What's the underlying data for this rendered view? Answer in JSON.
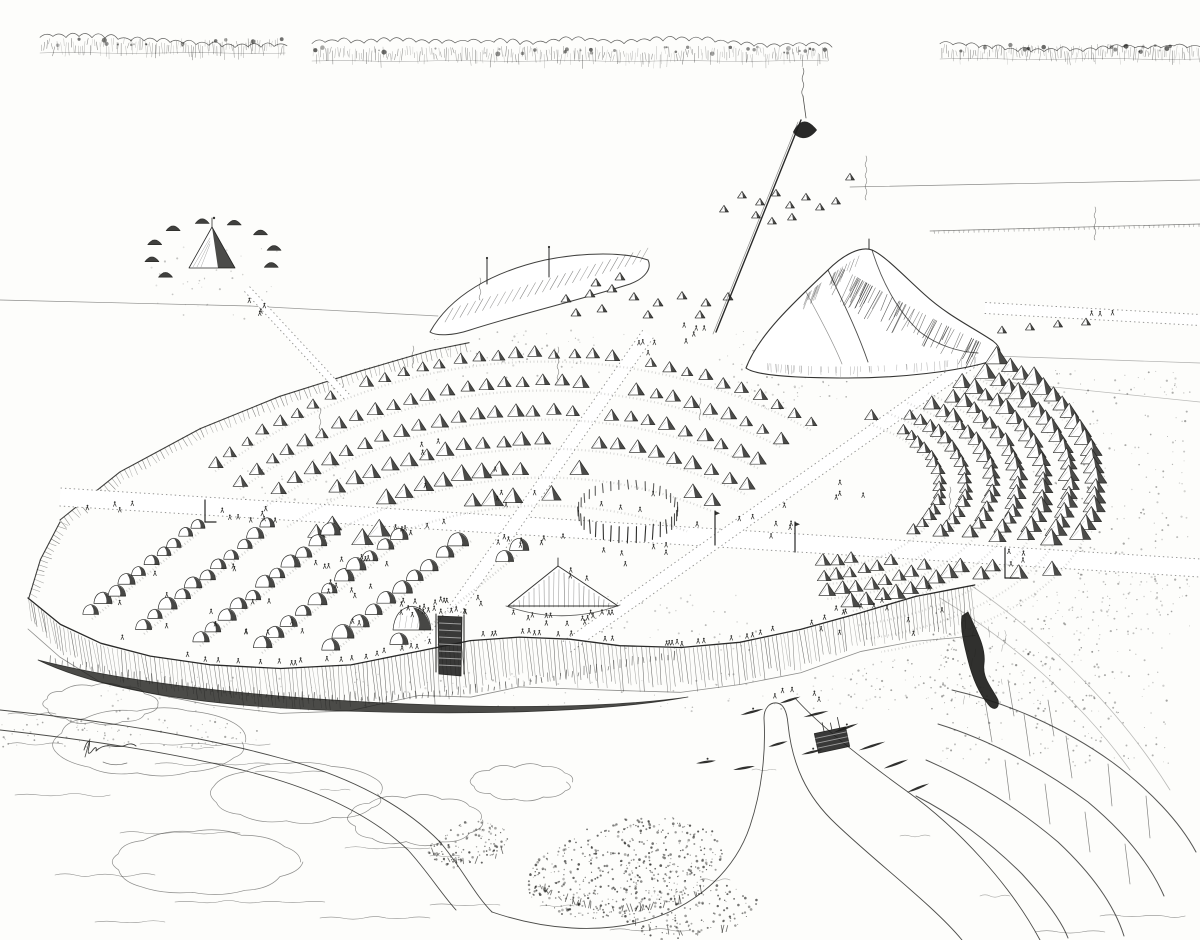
{
  "meta": {
    "title": "Pen-and-ink aerial reconstruction drawing of a fortified native settlement on a river bluff",
    "medium": "black ink on white paper",
    "ink": "#1e1e1c",
    "paper": "#fdfdfb",
    "signature_present": true,
    "signature_legible": false
  },
  "scene": {
    "treeline": [
      {
        "x1": 40,
        "x2": 285,
        "y": 50
      },
      {
        "x1": 312,
        "x2": 828,
        "y": 58
      },
      {
        "x1": 940,
        "x2": 1200,
        "y": 56
      }
    ],
    "field_lines": [
      [
        0,
        300,
        250,
        306,
        0.5
      ],
      [
        250,
        306,
        438,
        316,
        0.45
      ],
      [
        850,
        187,
        1200,
        180,
        0.5
      ],
      [
        995,
        356,
        1200,
        363,
        0.35
      ],
      [
        985,
        380,
        1200,
        402,
        0.3
      ],
      [
        940,
        598,
        1130,
        770,
        0.0
      ],
      [
        0,
        0,
        0,
        0,
        0
      ]
    ],
    "slope_lines": [
      "M940,598 C1010,640 1080,700 1130,770",
      "M972,586 C1050,640 1120,710 1170,790"
    ],
    "tick_line": [
      930,
      231,
      1200,
      224
    ],
    "stipple_patches": [
      [
        1030,
        370,
        160,
        250,
        260,
        0.3
      ],
      [
        700,
        330,
        150,
        55,
        60,
        0.28
      ],
      [
        430,
        330,
        200,
        50,
        55,
        0.25
      ],
      [
        240,
        460,
        110,
        50,
        35,
        0.22
      ],
      [
        600,
        595,
        170,
        55,
        45,
        0.25
      ],
      [
        930,
        600,
        170,
        110,
        150,
        0.35
      ],
      [
        940,
        646,
        230,
        120,
        160,
        0.3
      ],
      [
        100,
        672,
        850,
        40,
        140,
        0.22
      ],
      [
        1060,
        560,
        130,
        80,
        60,
        0.25
      ],
      [
        730,
        380,
        120,
        30,
        30,
        0.25
      ],
      [
        150,
        240,
        130,
        80,
        40,
        0.2
      ],
      [
        830,
        660,
        120,
        40,
        40,
        0.3
      ],
      [
        0,
        718,
        260,
        30,
        90,
        0.3
      ]
    ],
    "roads": [
      {
        "name": "east-west-road",
        "seg": [
          60,
          497,
          1200,
          568
        ],
        "half": 9
      },
      {
        "name": "northwest-road",
        "seg": [
          648,
          334,
          430,
          645
        ],
        "half": 6.5
      },
      {
        "name": "northeast-road",
        "seg": [
          985,
          352,
          565,
          648
        ],
        "half": 6.5
      },
      {
        "name": "satellite-path",
        "seg": [
          247,
          289,
          348,
          398
        ],
        "half": 3.5
      },
      {
        "name": "east-road",
        "seg": [
          985,
          308,
          1200,
          320
        ],
        "half": 5.5
      }
    ],
    "avoid": [
      [
        412,
        628,
        26
      ],
      [
        563,
        600,
        62
      ],
      [
        628,
        516,
        62
      ]
    ],
    "west_scarp": [
      [
        60,
        520
      ],
      [
        120,
        472
      ],
      [
        200,
        428
      ],
      [
        280,
        396
      ],
      [
        360,
        370
      ],
      [
        430,
        350
      ],
      [
        470,
        342
      ]
    ],
    "west_corner": [
      [
        60,
        522
      ],
      [
        40,
        560
      ],
      [
        28,
        598
      ]
    ],
    "satellite_camp": {
      "cx": 213,
      "cy": 256,
      "rx": 62,
      "ry": 33,
      "ring_angles": [
        140,
        170,
        200,
        230,
        260,
        290,
        320,
        350,
        20
      ],
      "cone": {
        "apex": [
          212,
          227
        ],
        "base_y": 268,
        "half_w": 23
      }
    },
    "ridge_mound": {
      "outline": "M430,332 C450,296 492,272 545,260 C585,252 625,252 648,260 C652,268 646,278 630,284 C580,300 520,314 470,330 C452,336 436,336 430,332 Z",
      "hatch_a": [
        445,
        322
      ],
      "hatch_b": [
        640,
        262
      ],
      "poles": [
        [
          487,
          258,
          26
        ],
        [
          549,
          247,
          30
        ]
      ]
    },
    "hut_clusters": {
      "north": [
        [
          742,
          198
        ],
        [
          760,
          205
        ],
        [
          776,
          196
        ],
        [
          790,
          208
        ],
        [
          806,
          200
        ],
        [
          820,
          210
        ],
        [
          836,
          204
        ],
        [
          756,
          218
        ],
        [
          772,
          224
        ],
        [
          792,
          220
        ],
        [
          850,
          180
        ],
        [
          724,
          212
        ]
      ],
      "ridge_east": [
        [
          566,
          302
        ],
        [
          590,
          297
        ],
        [
          612,
          292
        ],
        [
          634,
          300
        ],
        [
          658,
          306
        ],
        [
          682,
          299
        ],
        [
          706,
          306
        ],
        [
          728,
          300
        ],
        [
          576,
          316
        ],
        [
          602,
          312
        ],
        [
          648,
          318
        ],
        [
          700,
          318
        ],
        [
          596,
          286
        ],
        [
          620,
          280
        ]
      ],
      "east_road": [
        [
          1002,
          333
        ],
        [
          1030,
          330
        ],
        [
          1058,
          327
        ],
        [
          1086,
          325
        ]
      ]
    },
    "great_mound": {
      "outline": "M746,368 C758,336 792,304 828,270 C844,254 861,246 872,250 C884,255 902,274 924,294 C948,316 974,328 993,341 C1002,348 1002,356 995,360 C958,372 898,378 848,378 C798,378 756,376 746,368 Z",
      "ridge": "M828,270 C842,300 857,330 868,362",
      "terrace": "M872,250 C882,282 898,312 920,332 C938,346 960,352 978,353",
      "terrace2": "M806,292 C820,318 834,344 842,364",
      "hatch_se": [
        [
          838,
          266
        ],
        [
          904,
          306
        ],
        [
          988,
          346
        ]
      ],
      "hatch_nw": [
        [
          800,
          300
        ],
        [
          833,
          272
        ],
        [
          862,
          254
        ]
      ],
      "skirt": [
        [
          756,
          362
        ],
        [
          850,
          374
        ],
        [
          985,
          356
        ]
      ],
      "summit": [
        869,
        249
      ]
    },
    "arc_band_upper": {
      "cx": 545,
      "cy": 905,
      "rows": [
        [
          548,
          233,
          299,
          2.0,
          6.5
        ],
        [
          519,
          234,
          298,
          2.1,
          7.2
        ],
        [
          490,
          235,
          297,
          2.25,
          7.8
        ],
        [
          461,
          236,
          296,
          2.4,
          8.5
        ],
        [
          432,
          238,
          294,
          2.6,
          9.2
        ],
        [
          404,
          243,
          291,
          2.8,
          10
        ]
      ]
    },
    "arc_band_east": {
      "cx": 800,
      "cy": 488,
      "k": 0.56,
      "rows": [
        [
          140,
          -60,
          84,
          5.6,
          6.8
        ],
        [
          166,
          -58,
          82,
          5.0,
          7.4
        ],
        [
          192,
          -56,
          82,
          4.6,
          8.0
        ],
        [
          218,
          -54,
          80,
          4.2,
          8.6
        ],
        [
          244,
          -52,
          80,
          3.9,
          9.2
        ],
        [
          270,
          -50,
          78,
          3.6,
          9.7
        ],
        [
          296,
          -48,
          76,
          3.3,
          10.2
        ]
      ]
    },
    "post_circle": {
      "cx": 628,
      "cy": 516,
      "rx": 50,
      "ry": 27,
      "n": 36
    },
    "lodge_rows": {
      "dir": [
        0.78,
        -0.63
      ],
      "rows": [
        [
          92,
          614,
          10,
          8
        ],
        [
          144,
          629,
          11,
          8.4
        ],
        [
          200,
          641,
          11,
          8.8
        ],
        [
          262,
          648,
          12,
          9.2
        ],
        [
          330,
          650,
          11,
          9.6
        ],
        [
          400,
          645,
          9,
          10
        ]
      ]
    },
    "plaza_mound": {
      "x1": 508,
      "apex": [
        558,
        566
      ],
      "x2": 618,
      "base_y": 606
    },
    "dome_mound": {
      "cx": 412,
      "cy": 630,
      "s": 19
    },
    "bluff": [
      [
        28,
        598
      ],
      [
        60,
        625
      ],
      [
        100,
        644
      ],
      [
        150,
        656
      ],
      [
        210,
        664
      ],
      [
        280,
        668
      ],
      [
        350,
        664
      ],
      [
        420,
        650
      ],
      [
        470,
        640
      ],
      [
        520,
        637
      ],
      [
        570,
        640
      ],
      [
        620,
        645
      ],
      [
        680,
        648
      ],
      [
        740,
        642
      ],
      [
        800,
        630
      ],
      [
        860,
        612
      ],
      [
        915,
        597
      ],
      [
        955,
        588
      ],
      [
        975,
        584
      ]
    ],
    "gate": {
      "x": 438,
      "y": 616,
      "w": 24,
      "h": 60
    },
    "ravine": "M968,612 C978,634 986,648 984,664 C982,678 992,688 998,700 C1000,708 994,712 988,704 C978,692 972,676 968,660 C964,644 960,628 962,616 Z",
    "slough": "M38,660 C140,686 300,702 470,706 C560,708 640,704 688,697 C600,713 460,716 320,710 C200,705 100,690 38,660 Z",
    "river_banks": [
      "M0,710 C100,720 200,736 280,758 C350,776 405,806 440,842 C462,868 474,894 492,912",
      "M0,730 C90,740 180,754 250,772 C320,790 372,816 408,850 C428,872 440,892 456,910",
      "M492,912 C545,930 600,934 648,920 C700,904 736,868 750,826 C762,790 766,752 764,718 C764,708 770,702 777,703 C784,704 787,712 788,724 C792,764 806,796 836,824 C878,864 934,906 962,940",
      "M795,698 C818,724 858,756 908,792 C958,828 1010,884 1040,940"
    ],
    "water_wiggles": [
      [
        180,
        748,
        34
      ],
      [
        320,
        790,
        30
      ],
      [
        430,
        856,
        30
      ],
      [
        540,
        906,
        34
      ],
      [
        700,
        880,
        30
      ],
      [
        752,
        770,
        24
      ],
      [
        900,
        836,
        30
      ],
      [
        980,
        896,
        30
      ]
    ],
    "ground_wiggles": [
      [
        15,
        795,
        95
      ],
      [
        120,
        833,
        120
      ],
      [
        55,
        875,
        100
      ],
      [
        175,
        902,
        150
      ],
      [
        320,
        918,
        110
      ],
      [
        95,
        922,
        70
      ],
      [
        255,
        772,
        70
      ],
      [
        345,
        848,
        85
      ],
      [
        610,
        930,
        80
      ],
      [
        1100,
        916,
        85
      ],
      [
        1035,
        932,
        70
      ],
      [
        140,
        744,
        130
      ],
      [
        155,
        764,
        115
      ],
      [
        8,
        744,
        55
      ],
      [
        8,
        714,
        48
      ],
      [
        430,
        905,
        70
      ]
    ],
    "clouds": [
      [
        150,
        742,
        95,
        32
      ],
      [
        100,
        704,
        55,
        18
      ],
      [
        298,
        794,
        85,
        28
      ],
      [
        205,
        862,
        92,
        30
      ],
      [
        415,
        820,
        66,
        24
      ],
      [
        522,
        782,
        48,
        16
      ]
    ],
    "tree_masses": [
      [
        625,
        868,
        100,
        48,
        -12,
        520
      ],
      [
        468,
        844,
        42,
        22,
        -15,
        120
      ],
      [
        690,
        912,
        70,
        26,
        -8,
        140
      ]
    ],
    "right_bluffs": {
      "curves": [
        "M952,690 C1004,702 1062,726 1112,762 C1150,790 1180,822 1196,852",
        "M938,724 C990,740 1042,768 1088,802 C1124,832 1150,864 1164,896",
        "M926,760 C972,780 1018,808 1058,842 C1090,872 1114,904 1124,936",
        "M916,796 C952,814 990,842 1022,874 C1046,900 1062,922 1068,938"
      ],
      "cracks": [
        [
          985,
          700,
          992,
          742
        ],
        [
          1024,
          714,
          1030,
          756
        ],
        [
          1066,
          736,
          1072,
          778
        ],
        [
          1108,
          764,
          1112,
          806
        ],
        [
          1146,
          796,
          1150,
          838
        ],
        [
          1008,
          680,
          1014,
          716
        ],
        [
          1048,
          700,
          1054,
          736
        ],
        [
          1005,
          760,
          1010,
          800
        ],
        [
          1045,
          784,
          1050,
          824
        ],
        [
          1085,
          812,
          1090,
          852
        ],
        [
          1125,
          844,
          1130,
          884
        ]
      ]
    },
    "canoes": [
      [
        752,
        712,
        -15,
        24
      ],
      [
        790,
        700,
        -18,
        22
      ],
      [
        816,
        714,
        -14,
        26
      ],
      [
        846,
        728,
        -20,
        26
      ],
      [
        872,
        746,
        -18,
        28
      ],
      [
        896,
        764,
        -20,
        26
      ],
      [
        812,
        752,
        -14,
        22
      ],
      [
        778,
        744,
        -16,
        20
      ],
      [
        744,
        768,
        -10,
        22
      ],
      [
        706,
        762,
        -8,
        20
      ],
      [
        918,
        788,
        -22,
        24
      ]
    ],
    "raft": {
      "x": 832,
      "y": 740,
      "w": 32,
      "h": 20,
      "ang": -12
    },
    "marker_posts": [
      [
        715,
        545,
        34
      ],
      [
        795,
        552,
        30
      ]
    ],
    "l_posts": [
      [
        205,
        500,
        22,
        11
      ],
      [
        1005,
        548,
        30,
        14
      ]
    ],
    "tall_pole": {
      "base": [
        716,
        332
      ],
      "top": [
        801,
        120
      ],
      "cap": "M793,132 Q803,112 817,130 Q810,139 802,138 Q796,137 793,132 Z"
    },
    "smokes": [
      [
        413,
        368,
        26
      ],
      [
        558,
        380,
        30
      ],
      [
        866,
        200,
        40
      ],
      [
        1095,
        240,
        33
      ],
      [
        700,
        420,
        24
      ],
      [
        320,
        430,
        26
      ],
      [
        950,
        520,
        28
      ],
      [
        480,
        300,
        22
      ]
    ],
    "crowds": [
      {
        "x": 442,
        "y": 607,
        "rx": 42,
        "ry": 9,
        "n": 22
      },
      {
        "x": 564,
        "y": 618,
        "rx": 52,
        "ry": 6,
        "n": 15
      },
      {
        "x": 600,
        "y": 538,
        "rx": 110,
        "ry": 45,
        "n": 13
      },
      {
        "x": 252,
        "y": 515,
        "rx": 38,
        "ry": 7,
        "n": 8
      },
      {
        "x": 416,
        "y": 527,
        "rx": 28,
        "ry": 7,
        "n": 6
      },
      {
        "x": 516,
        "y": 540,
        "rx": 28,
        "ry": 7,
        "n": 7
      },
      {
        "x": 642,
        "y": 350,
        "rx": 16,
        "ry": 8,
        "n": 4
      },
      {
        "x": 762,
        "y": 523,
        "rx": 38,
        "ry": 18,
        "n": 7
      },
      {
        "x": 845,
        "y": 492,
        "rx": 20,
        "ry": 10,
        "n": 4
      },
      {
        "x": 258,
        "y": 600,
        "rx": 150,
        "ry": 45,
        "n": 24
      },
      {
        "x": 880,
        "y": 622,
        "rx": 66,
        "ry": 16,
        "n": 9
      },
      {
        "x": 262,
        "y": 306,
        "rx": 13,
        "ry": 9,
        "n": 4
      },
      {
        "x": 1012,
        "y": 557,
        "rx": 12,
        "ry": 8,
        "n": 4
      },
      {
        "x": 800,
        "y": 697,
        "rx": 26,
        "ry": 9,
        "n": 5
      },
      {
        "x": 700,
        "y": 332,
        "rx": 28,
        "ry": 10,
        "n": 5
      },
      {
        "x": 110,
        "y": 506,
        "rx": 28,
        "ry": 6,
        "n": 4
      },
      {
        "x": 480,
        "y": 470,
        "rx": 60,
        "ry": 30,
        "n": 6
      },
      {
        "x": 340,
        "y": 575,
        "rx": 60,
        "ry": 20,
        "n": 8
      },
      {
        "x": 628,
        "y": 552,
        "rx": 40,
        "ry": 8,
        "n": 5
      },
      {
        "x": 1100,
        "y": 316,
        "rx": 14,
        "ry": 4,
        "n": 3
      }
    ],
    "bluff_crowd": {
      "x_from": 180,
      "x_to": 930,
      "n": 48
    },
    "signature": {
      "d": "M84,750 c3,-10 7,-12 5,-3 c-2,7 0,8 3,4 c3,-4 5,-5 4,0 c5,-5 10,-6 16,-5 c6,1 10,1 14,-1 c4,-2 8,-1 10,1",
      "cross": [
        90,
        739,
        85,
        757
      ],
      "flourish": "M103,762 q12,5 24,1"
    }
  }
}
